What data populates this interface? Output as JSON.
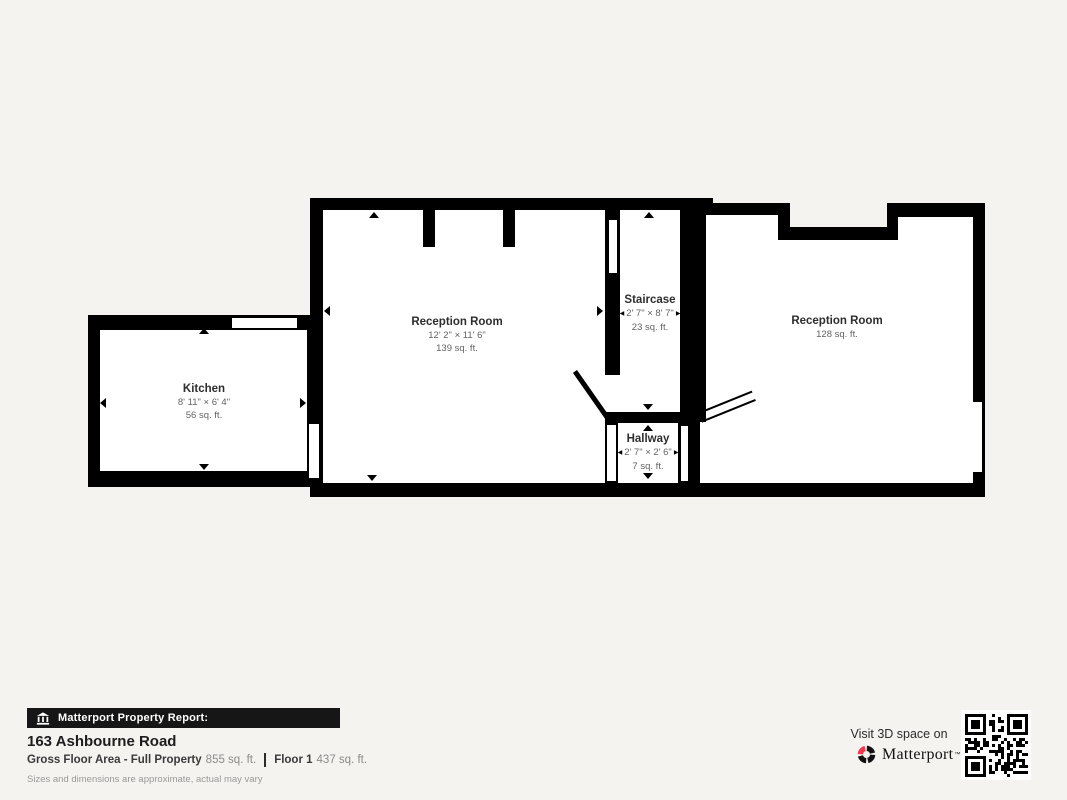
{
  "page": {
    "background": "#f4f3f0",
    "wall_color": "#000000",
    "floor_color": "#ffffff"
  },
  "floorplan": {
    "rooms": [
      {
        "id": "kitchen",
        "name": "Kitchen",
        "dimensions": "8' 11\" × 6' 4\"",
        "area": "56 sq. ft."
      },
      {
        "id": "reception-room-1",
        "name": "Reception Room",
        "dimensions": "12' 2\" × 11' 6\"",
        "area": "139 sq. ft."
      },
      {
        "id": "staircase",
        "name": "Staircase",
        "dimensions": "2' 7\" × 8' 7\"",
        "area": "23 sq. ft."
      },
      {
        "id": "hallway",
        "name": "Hallway",
        "dimensions": "2' 7\" × 2' 6\"",
        "area": "7 sq. ft."
      },
      {
        "id": "reception-room-2",
        "name": "Reception Room",
        "area": "128 sq. ft."
      }
    ]
  },
  "footer": {
    "report_banner": "Matterport Property Report:",
    "address": "163 Ashbourne Road",
    "gross_floor_area_label": "Gross Floor Area - Full Property",
    "gross_floor_area_value": "855 sq. ft.",
    "floor_label": "Floor 1",
    "floor_value": "437 sq. ft.",
    "disclaimer": "Sizes and dimensions are approximate, actual may vary"
  },
  "cta": {
    "visit_text": "Visit 3D space on",
    "brand": "Matterport",
    "brand_mark": "™",
    "brand_color": "#f4364c"
  },
  "icons": {
    "banner_icon": "building-columns-icon",
    "brand_icon": "matterport-pinwheel-icon",
    "qr": "qr-code",
    "dim_arrow_left": "◀",
    "dim_arrow_right": "▶"
  }
}
